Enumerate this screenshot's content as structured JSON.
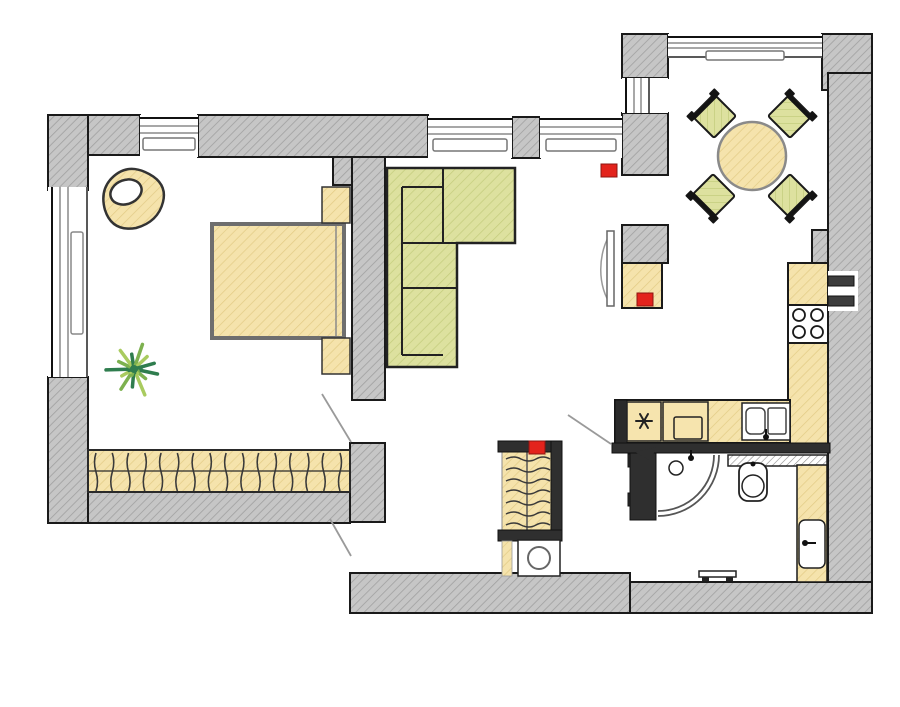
{
  "meta": {
    "kind": "apartment-floor-plan",
    "visible_text": []
  },
  "colors": {
    "background": "#ffffff",
    "wall_fill": "#c6c6c6",
    "wall_hatch": "#a0a0a0",
    "outline": "#1a1a1a",
    "partition": "#2f2f2f",
    "wood_fill": "#f5e3ac",
    "wood_hatch": "#e2cb85",
    "wood_plain": "#f6e4ae",
    "upholstery_fill": "#dde19f",
    "upholstery_hatch": "#c3cc7c",
    "marker_red": "#e3231c",
    "marker_red_border": "#8e1410",
    "window_line": "#8a8a8a",
    "door_swing": "#9a9a9a",
    "shelf_hatch": "#8a8a8a",
    "plant_greens": [
      "#2f7d4e",
      "#7db14f",
      "#a9cb5f"
    ]
  },
  "rooms": [
    "bedroom",
    "living-room",
    "dining-area",
    "kitchen",
    "hallway",
    "bathroom"
  ],
  "markers": {
    "size": {
      "w": 16,
      "h": 13
    },
    "positions": [
      {
        "x": 601,
        "y": 164
      },
      {
        "x": 637,
        "y": 293
      },
      {
        "x": 529,
        "y": 441
      }
    ]
  },
  "dining": {
    "table": {
      "cx": 752,
      "cy": 156,
      "r": 34
    },
    "chairs": [
      {
        "cx": 714,
        "cy": 116,
        "rot": -45
      },
      {
        "cx": 790,
        "cy": 116,
        "rot": 45
      },
      {
        "cx": 713,
        "cy": 196,
        "rot": -135
      },
      {
        "cx": 790,
        "cy": 196,
        "rot": 135
      }
    ]
  },
  "kitchen": {
    "stove_burners": 4,
    "sink_bowls": 2
  },
  "bedroom": {
    "wardrobe_hangers": 16,
    "nightstands": 2,
    "double_bed": true
  },
  "hall_closet": {
    "hangers": 7,
    "washing_machine": true
  },
  "plant": {
    "cx": 134,
    "cy": 369,
    "rays": 13
  }
}
